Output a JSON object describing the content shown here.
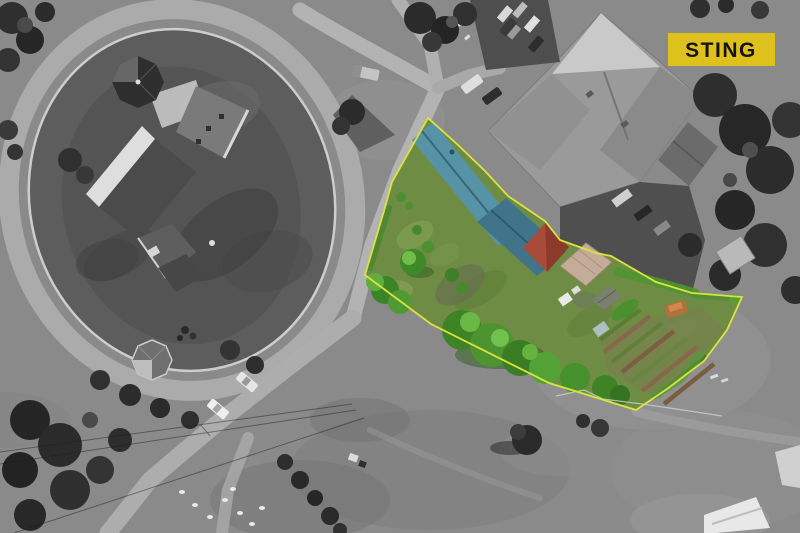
{
  "image": {
    "kind": "aerial-drone-photo",
    "style": "grayscale surroundings with colour-highlighted real-estate plot",
    "width_px": 800,
    "height_px": 533
  },
  "badge": {
    "label": "STING",
    "bg": "#dfc11d",
    "fg": "#17140f"
  },
  "colors": {
    "lawn": "#6f8c45",
    "boundary": "#dce23f",
    "roof_teal": "#5793a7",
    "roof_teal_dark": "#41748b",
    "roof_red": "#a84b38",
    "roof_red_dark": "#8c3a2c",
    "carport": "#c4ad98",
    "tree_green": "#3f8a28",
    "garden_soil": "#86684a",
    "garden_crop": "#5e8038"
  },
  "property": {
    "highlight": "saturated colour inside surveyed boundary",
    "features": [
      "teal-gable-roof-house",
      "teal-extension-roof",
      "red-hip-roof",
      "tan-carport",
      "garden-sheds",
      "vegetable-beds",
      "lawn",
      "trees-and-topiary"
    ]
  },
  "surroundings": [
    "fortified-church-with-oval-wall",
    "ring-road",
    "octagonal-gazebo",
    "large-gray-hip-roof-building",
    "parked-cars",
    "service-yard-trucks",
    "tree-masses",
    "field-with-power-lines",
    "white-roof-buildings"
  ]
}
